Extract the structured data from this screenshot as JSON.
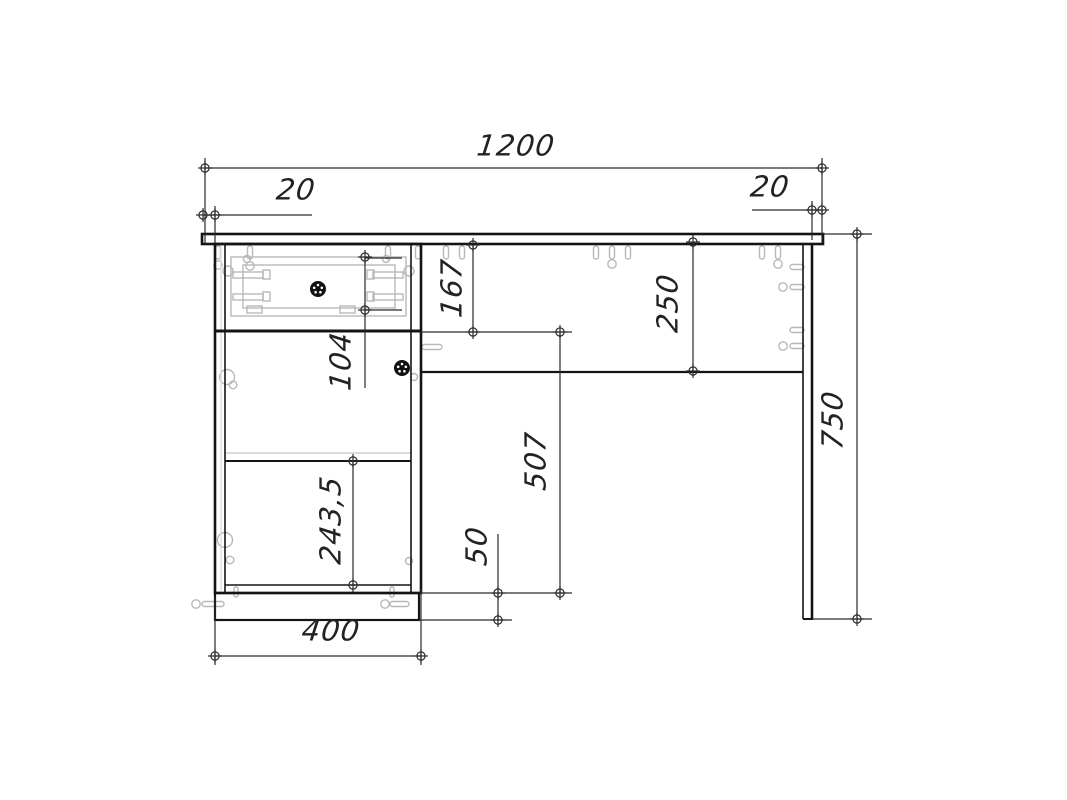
{
  "drawing": {
    "type": "furniture-assembly-front-view",
    "background": "#ffffff",
    "colors": {
      "outline": "#141414",
      "dimension_lines": "#2a2a2a",
      "fittings": "#b8b8b8",
      "knob": "#111111"
    },
    "dimensions": {
      "total_width": "1200",
      "left_overhang": "20",
      "right_overhang": "20",
      "total_height": "750",
      "drawer_section_height": "167",
      "top_clearance_height": "250",
      "drawer_opening_height": "104",
      "knee_clearance_height": "507",
      "door_panel_height": "243,5",
      "plinth_height": "50",
      "pedestal_width": "400"
    }
  }
}
